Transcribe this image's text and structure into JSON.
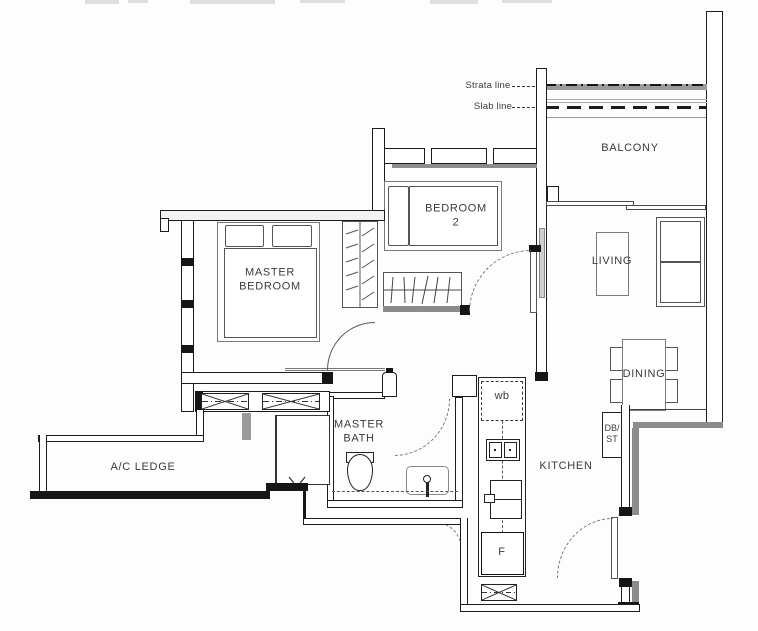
{
  "floorplan": {
    "annotations": {
      "strata_line": "Strata line",
      "slab_line": "Slab line"
    },
    "rooms": {
      "balcony": "BALCONY",
      "bedroom2": "BEDROOM\n2",
      "master_bedroom": "MASTER\nBEDROOM",
      "living": "LIVING",
      "dining": "DINING",
      "kitchen": "KITCHEN",
      "master_bath": "MASTER\nBATH",
      "ac_ledge": "A/C LEDGE"
    },
    "fixtures": {
      "wash_bay": "wb",
      "fridge": "F",
      "db_store": "DB/\nST"
    },
    "colors": {
      "wall": "#161616",
      "party_wall_gray": "#8c8c8c",
      "line_gray": "#9a9a9a",
      "label_text": "#3b3b3b"
    }
  }
}
